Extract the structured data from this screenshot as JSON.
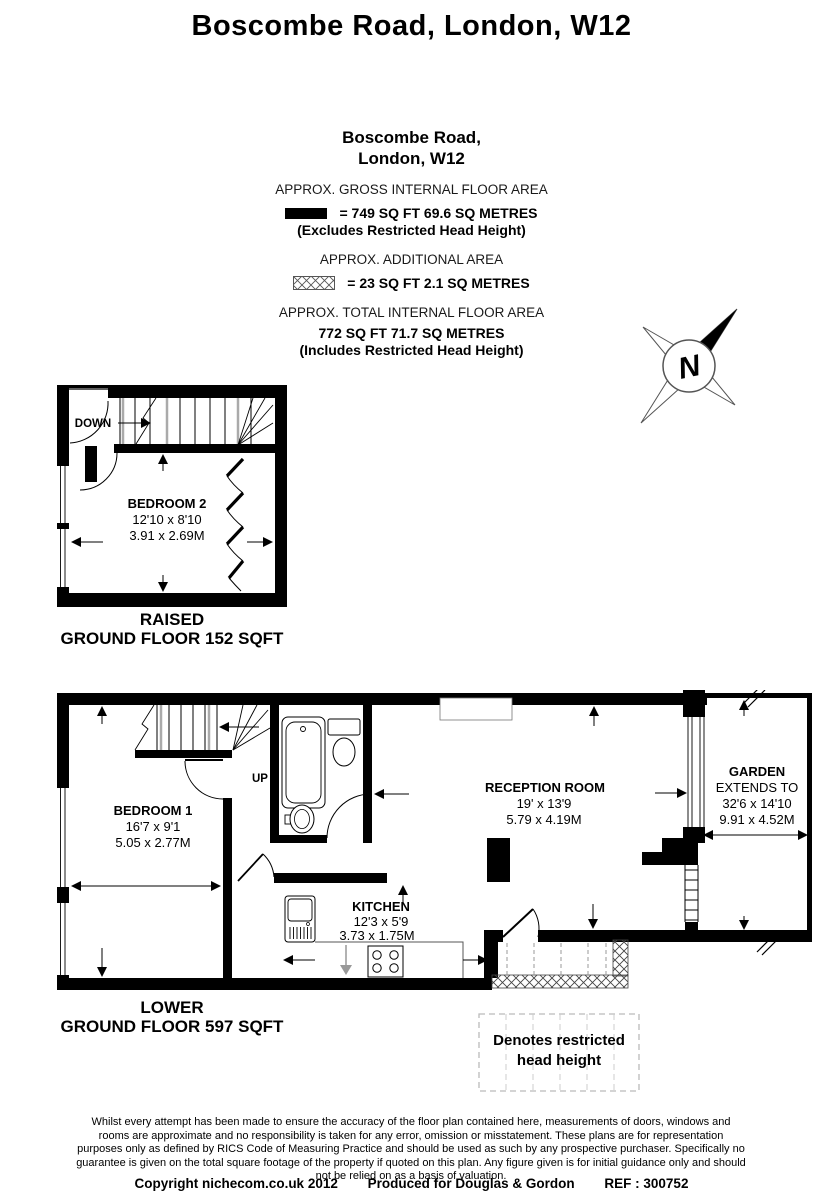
{
  "page_title": "Boscombe Road, London, W12",
  "info": {
    "address_line1": "Boscombe Road,",
    "address_line2": "London, W12",
    "gross_label": "APPROX. GROSS INTERNAL FLOOR AREA",
    "gross_value": "= 749 SQ FT 69.6 SQ METRES",
    "gross_note": "(Excludes Restricted Head Height)",
    "additional_label": "APPROX. ADDITIONAL AREA",
    "additional_value": "=  23 SQ FT 2.1 SQ METRES",
    "total_label": "APPROX. TOTAL INTERNAL FLOOR AREA",
    "total_value": "772 SQ FT 71.7  SQ METRES",
    "total_note": "(Includes Restricted Head Height)"
  },
  "compass": {
    "north_label": "N"
  },
  "raised_floor": {
    "down_label": "DOWN",
    "bedroom2": {
      "name": "BEDROOM 2",
      "imperial": "12'10 x 8'10",
      "metric": "3.91 x 2.69M"
    },
    "caption_line1": "RAISED",
    "caption_line2": "GROUND FLOOR 152 SQFT"
  },
  "lower_floor": {
    "up_label": "UP",
    "bedroom1": {
      "name": "BEDROOM 1",
      "imperial": "16'7 x 9'1",
      "metric": "5.05 x 2.77M"
    },
    "kitchen": {
      "name": "KITCHEN",
      "imperial": "12'3 x 5'9",
      "metric": "3.73 x 1.75M"
    },
    "reception": {
      "name": "RECEPTION ROOM",
      "imperial": "19' x 13'9",
      "metric": "5.79 x 4.19M"
    },
    "garden": {
      "name": "GARDEN",
      "extends_label": "EXTENDS TO",
      "imperial": "32'6 x 14'10",
      "metric": "9.91 x 4.52M"
    },
    "caption_line1": "LOWER",
    "caption_line2": "GROUND FLOOR 597 SQFT"
  },
  "legend": {
    "restricted_line1": "Denotes restricted",
    "restricted_line2": "head height"
  },
  "footer": {
    "disclaimer": "Whilst every attempt has been made to ensure the accuracy of the floor plan contained here, measurements of doors, windows and rooms are approximate and no responsibility is taken for any error, omission or misstatement. These plans are for representation purposes only as defined by RICS Code of Measuring Practice and should be used as such by any prospective purchaser. Specifically no guarantee is given on the total square footage of the property if quoted on this plan. Any figure given is for initial guidance only and should not be relied on as a basis of valuation.",
    "copyright": "Copyright nichecom.co.uk 2012",
    "produced": "Produced for Douglas & Gordon",
    "ref": "REF : 300752"
  },
  "colors": {
    "wall": "#000000",
    "stair_gray": "#aaaaaa",
    "dash_gray": "#999999"
  }
}
